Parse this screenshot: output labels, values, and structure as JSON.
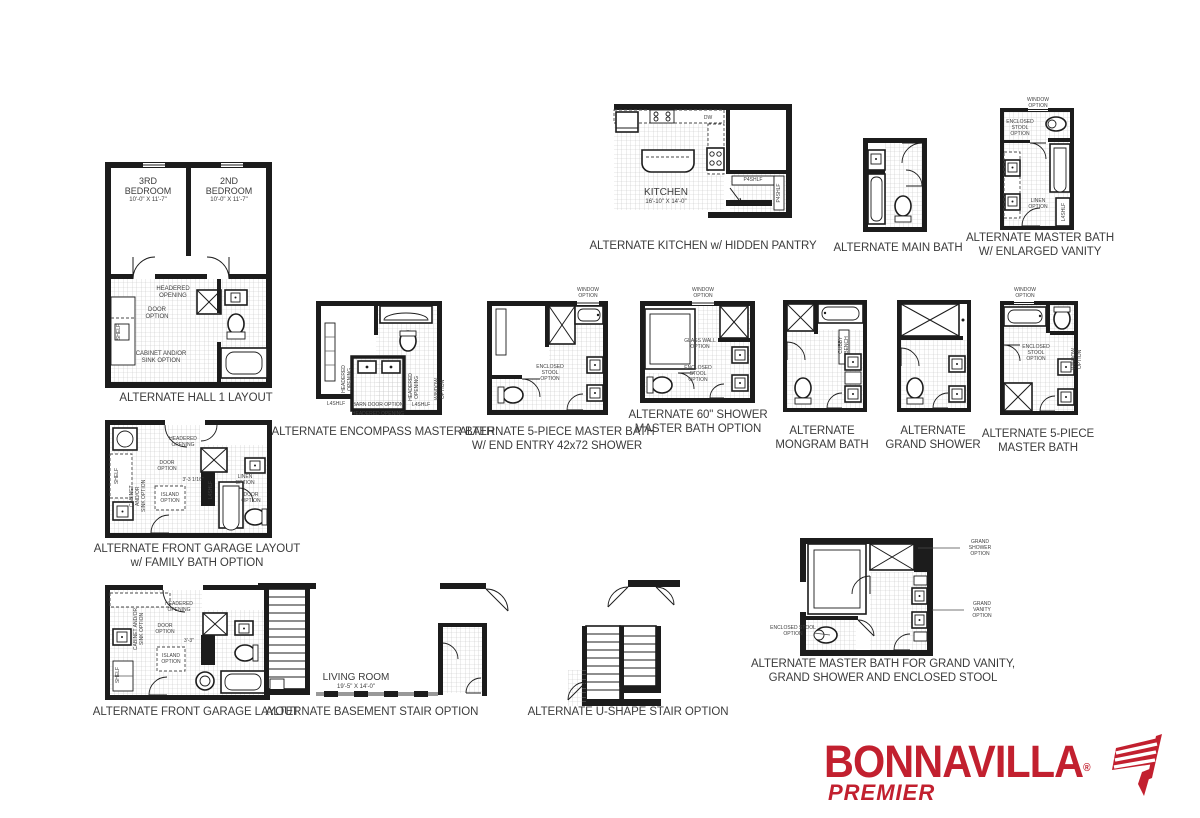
{
  "brand": {
    "name": "BONNAVILLA",
    "reg": "®",
    "premier": "PREMIER",
    "color": "#C2202F"
  },
  "plans": {
    "hall1": {
      "caption": "ALTERNATE HALL 1 LAYOUT",
      "bed3_name": "3RD\nBEDROOM",
      "bed3_dim": "10'-0\" X 11'-7\"",
      "bed2_name": "2ND\nBEDROOM",
      "bed2_dim": "10'-0\" X 11'-7\"",
      "headered": "HEADERED\nOPENING",
      "door": "DOOR\nOPTION",
      "shelf": "SHELF",
      "cabinet": "CABINET AND/OR\nSINK OPTION"
    },
    "kitchen": {
      "caption": "ALTERNATE KITCHEN w/ HIDDEN PANTRY",
      "room": "KITCHEN",
      "dim": "16'-10\" X 14'-0\"",
      "dw": "DW",
      "pantry": "P4SHLF",
      "pantry_side": "P4SHLF"
    },
    "main_bath": {
      "caption": "ALTERNATE MAIN BATH"
    },
    "master_vanity": {
      "caption1": "ALTERNATE MASTER BATH",
      "caption2": "W/ ENLARGED VANITY",
      "window": "WINDOW OPTION",
      "stool": "ENCLOSED\nSTOOL\nOPTION",
      "linen": "LINEN\nOPTION",
      "l4shlf": "L4SHLF"
    },
    "encompass": {
      "caption": "ALTERNATE ENCOMPASS MASTER BATH",
      "headered_l": "HEADERED\nOPENING",
      "headered_r": "HEADERED\nOPENING",
      "headered_b": "HEADERED OPENING",
      "l4shlf_l": "L4SHLF",
      "l4shlf_r": "L4SHLF",
      "barn": "BARN DOOR OPTION",
      "window": "WINDOW\nOPTION"
    },
    "five_end": {
      "caption1": "ALTERNATE 5-PIECE MASTER  BATH",
      "caption2": "W/ END ENTRY 42x72 SHOWER",
      "window": "WINDOW\nOPTION",
      "stool": "ENCLOSED\nSTOOL\nOPTION"
    },
    "shower60": {
      "caption1": "ALTERNATE 60\" SHOWER",
      "caption2": "MASTER BATH OPTION",
      "window": "WINDOW\nOPTION",
      "glass": "GLASS WALL\nOPTION",
      "stool": "ENCLOSED\nSTOOL\nOPTION"
    },
    "mongram": {
      "caption1": "ALTERNATE",
      "caption2": "MONGRAM BATH",
      "cubby": "CUBBY\nBENCH"
    },
    "grand_shower": {
      "caption1": "ALTERNATE",
      "caption2": "GRAND SHOWER"
    },
    "five2": {
      "caption1": "ALTERNATE 5-PIECE",
      "caption2": "MASTER BATH",
      "window": "WINDOW\nOPTION",
      "stool": "ENCLOSED\nSTOOL\nOPTION",
      "window_side": "WINDOW\nOPTION"
    },
    "garage_family": {
      "caption1": "ALTERNATE FRONT GARAGE LAYOUT",
      "caption2": "w/ FAMILY BATH OPTION",
      "headered": "HEADERED\nOPENING",
      "door": "DOOR\nOPTION",
      "dim": "3'-3 1/16\"",
      "island": "ISLAND\nOPTION",
      "shelf": "SHELF",
      "cabinet": "CABINET AND/OR\nSINK OPTION",
      "linen": "LINEN\nOPTION",
      "l4shlf": "L4SHLF",
      "door2": "DOOR\nOPTION"
    },
    "garage": {
      "caption": "ALTERNATE FRONT GARAGE LAYOUT",
      "headered": "HEADERED\nOPENING",
      "door": "DOOR\nOPTION",
      "dim": "3'-3\"",
      "island": "ISLAND\nOPTION",
      "cabinet": "CABINET AND/OR\nSINK OPTION",
      "shelf": "SHELF"
    },
    "basement": {
      "caption": "ALTERNATE BASEMENT STAIR OPTION",
      "room": "LIVING ROOM",
      "dim": "19'-5\" X 14'-0\""
    },
    "ustair": {
      "caption": "ALTERNATE U-SHAPE STAIR OPTION"
    },
    "grand_master": {
      "caption1": "ALTERNATE MASTER BATH FOR GRAND VANITY,",
      "caption2": "GRAND SHOWER AND ENCLOSED STOOL",
      "shower": "GRAND SHOWER\nOPTION",
      "vanity": "GRAND VANITY\nOPTION",
      "stool": "ENCLOSED STOOL\nOPTION"
    }
  }
}
